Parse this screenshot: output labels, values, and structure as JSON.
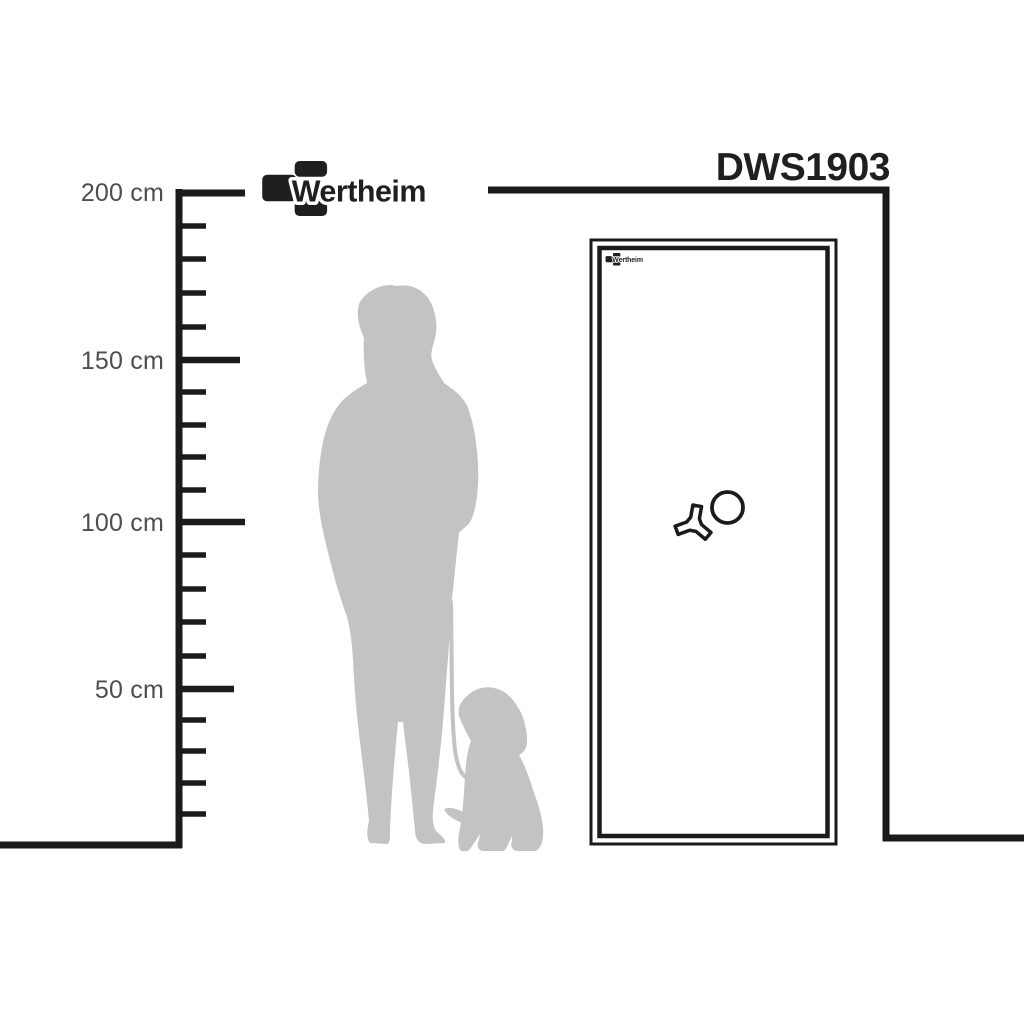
{
  "product": {
    "model": "DWS1903",
    "brand": "Wertheim"
  },
  "ruler": {
    "unit": "cm",
    "labels": [
      "200 cm",
      "150 cm",
      "100 cm",
      "50 cm"
    ],
    "max_cm": 200,
    "major_interval_cm": 50,
    "minor_interval_cm": 10
  },
  "icons": {
    "brand_mark": "wertheim-bracket-mark-icon",
    "handle": "tri-spoke-handle-icon",
    "dial": "round-dial-icon",
    "person": "woman-silhouette",
    "dog": "dog-silhouette",
    "leash": "leash-line"
  },
  "colors": {
    "line_black": "#1b1b1b",
    "text_black": "#1f1f1f",
    "label_gray": "#4d4e50",
    "silhouette_gray": "#c3c3c3",
    "background": "#ffffff"
  }
}
